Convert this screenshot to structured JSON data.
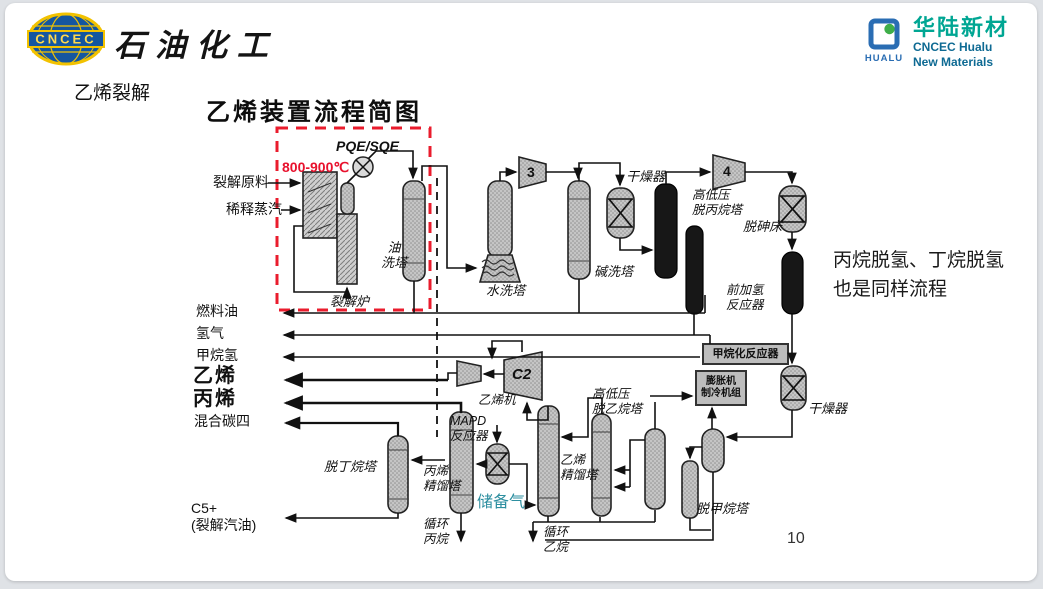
{
  "header": {
    "section_title": "乙烯裂解",
    "cncec": {
      "logo_text": "CNCEC",
      "brand": "石油化工"
    },
    "hualu": {
      "logo_text": "HUALU",
      "name_cn": "华陆新材",
      "name_en_1": "CNCEC Hualu",
      "name_en_2": "New Materials"
    }
  },
  "diagram": {
    "title": "乙烯装置流程简图",
    "annotations": {
      "temperature": "800-900℃",
      "pqe_sqe": "PQE/SQE",
      "side_note": "丙烷脱氢、丁烷脱氢\n也是同样流程",
      "page_number": "10"
    },
    "feeds": {
      "cracking_feed": "裂解原料",
      "dilution_steam": "稀释蒸汽"
    },
    "products": {
      "fuel_oil": "燃料油",
      "hydrogen": "氢气",
      "methane_hydrogen": "甲烷氢",
      "ethylene": "乙烯",
      "propylene": "丙烯",
      "mixed_c4": "混合碳四",
      "c5_plus": "C5+\n(裂解汽油)",
      "recycle_propane": "循环\n丙烷",
      "recycle_ethane": "循环\n乙烷",
      "reserve_gas": "储备气"
    },
    "equipment": {
      "cracking_furnace": "裂解炉",
      "oil_wash_tower": "油\n洗塔",
      "water_wash_tower": "水洗塔",
      "caustic_wash_tower": "碱洗塔",
      "dryer_1": "干燥器",
      "dryer_2": "干燥器",
      "compressor_3": "3",
      "compressor_4": "4",
      "depropanizer": "高低压\n脱丙烷塔",
      "arsenic_removal_bed": "脱砷床",
      "front_hydrogenation_reactor": "前加氢\n反应器",
      "methanation_reactor": "甲烷化反应器",
      "expander_chiller_unit": "膨胀机\n制冷机组",
      "demethanizer": "脱甲烷塔",
      "deethanizer": "高低压\n脱乙烷塔",
      "ethylene_compressor": "乙烯机",
      "c2_compressor": "C2",
      "mapd_reactor": "MAPD\n反应器",
      "ethylene_tower": "乙烯\n精馏塔",
      "propylene_tower": "丙烯\n精馏塔",
      "debutanizer": "脱丁烷塔"
    },
    "colors": {
      "annotation_red": "#e8112d",
      "reserve_gas_teal": "#2e8fa0",
      "cncec_blue": "#1456a0",
      "cncec_yellow": "#f2c200",
      "hualu_teal": "#00a693",
      "hualu_blue": "#2a6db3"
    }
  }
}
